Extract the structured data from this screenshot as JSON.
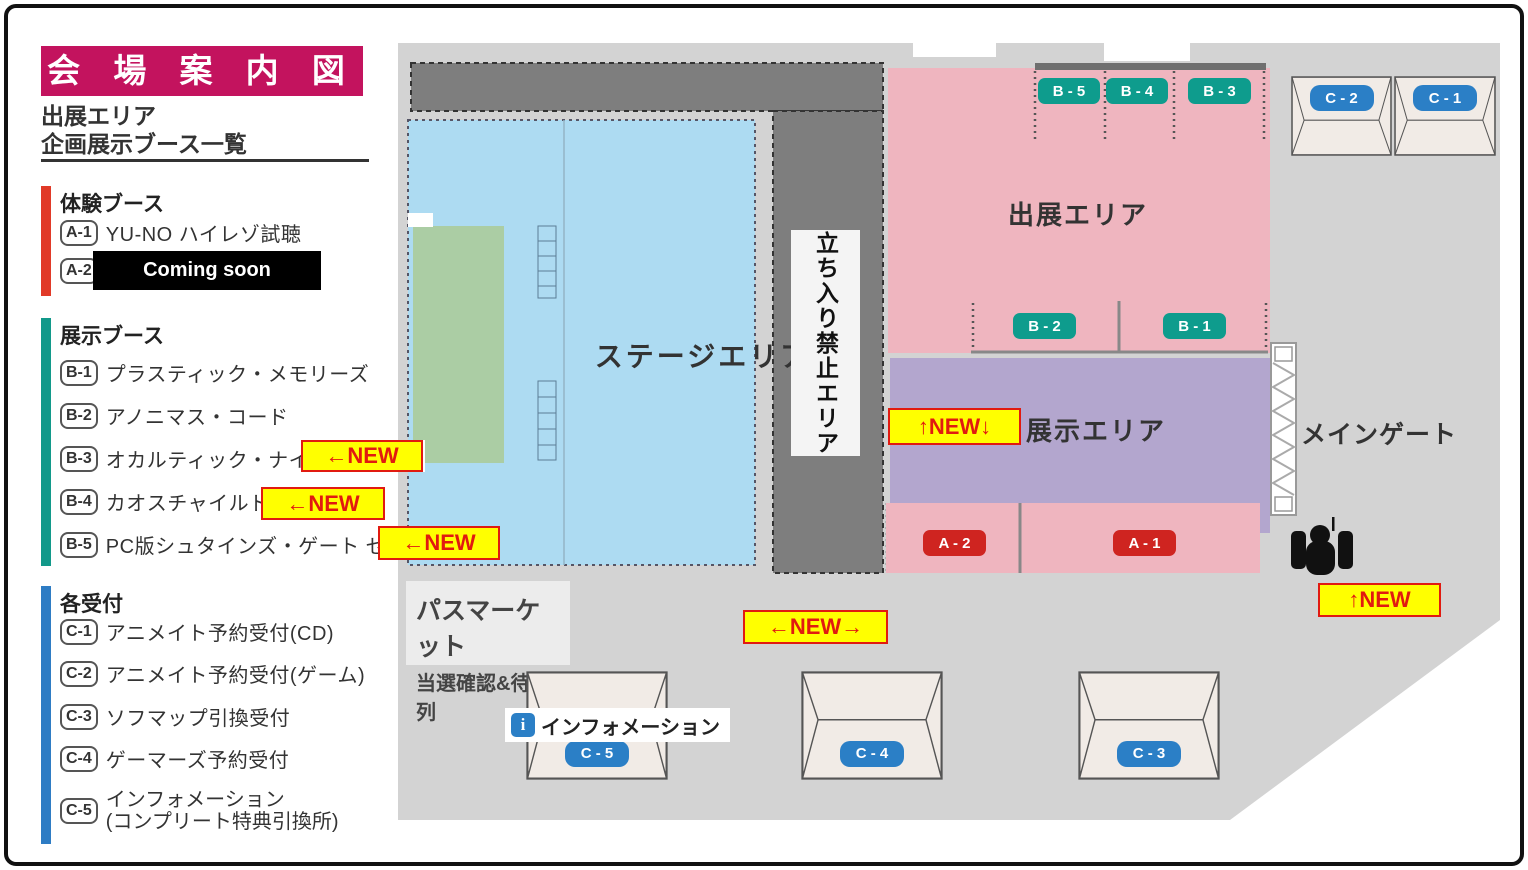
{
  "legend": {
    "title": "会 場 案 内 図",
    "subtitle_line1": "出展エリア",
    "subtitle_line2": "企画展示ブース一覧",
    "experience": {
      "header": "体験ブース",
      "items": [
        {
          "code": "A-1",
          "label": "YU-NO ハイレゾ試聴"
        },
        {
          "code": "A-2",
          "label": ""
        }
      ],
      "coming_soon": "Coming soon"
    },
    "exhibit": {
      "header": "展示ブース",
      "items": [
        {
          "code": "B-1",
          "label": "プラスティック・メモリーズ"
        },
        {
          "code": "B-2",
          "label": "アノニマス・コード"
        },
        {
          "code": "B-3",
          "label": "オカルティック・ナイン"
        },
        {
          "code": "B-4",
          "label": "カオスチャイルド"
        },
        {
          "code": "B-5",
          "label": "PC版シュタインズ・ゲート ゼロ"
        }
      ]
    },
    "reception": {
      "header": "各受付",
      "items": [
        {
          "code": "C-1",
          "label": "アニメイト予約受付(CD)"
        },
        {
          "code": "C-2",
          "label": "アニメイト予約受付(ゲーム)"
        },
        {
          "code": "C-3",
          "label": "ソフマップ引換受付"
        },
        {
          "code": "C-4",
          "label": "ゲーマーズ予約受付"
        },
        {
          "code": "C-5",
          "label": "インフォメーション",
          "label2": "(コンプリート特典引換所)"
        }
      ]
    }
  },
  "map": {
    "area_labels": {
      "stage": "ステージエリア",
      "no_entry": "立ち入り禁止エリア",
      "exhibition_area": "出展エリア",
      "display_area": "展示エリア",
      "main_gate": "メインゲート"
    },
    "pass_market": {
      "line1": "パスマーケット",
      "line2": "当選確認&待機列"
    },
    "information_label": "インフォメーション",
    "badges": {
      "b5": "B - 5",
      "b4": "B - 4",
      "b3": "B - 3",
      "b2": "B - 2",
      "b1": "B - 1",
      "a2": "A - 2",
      "a1": "A - 1",
      "c2": "C - 2",
      "c1": "C - 1",
      "c5": "C - 5",
      "c4": "C - 4",
      "c3": "C - 3"
    },
    "new_labels": {
      "b3_row": "←NEW",
      "b4_row": "←NEW",
      "b5_row": "←NEW",
      "display_area": "↑NEW↓",
      "mid_bottom": "←NEW→",
      "gate": "↑NEW"
    }
  },
  "colors": {
    "banner": "#c3135e",
    "experience_bar": "#e13a28",
    "exhibit_bar": "#12998a",
    "reception_bar": "#2e7cc4",
    "pink_area": "#efb5bf",
    "purple_area": "#b3a6ce",
    "stage_blue": "#addbf2",
    "stage_green": "#abcda4",
    "map_gray": "#d3d3d3",
    "wall_gray": "#7e7e7e",
    "badge_teal": "#0e9c8d",
    "badge_red": "#cf2420",
    "badge_blue": "#2b7fc6",
    "new_yellow": "#ffff00",
    "new_red": "#e11a10"
  }
}
